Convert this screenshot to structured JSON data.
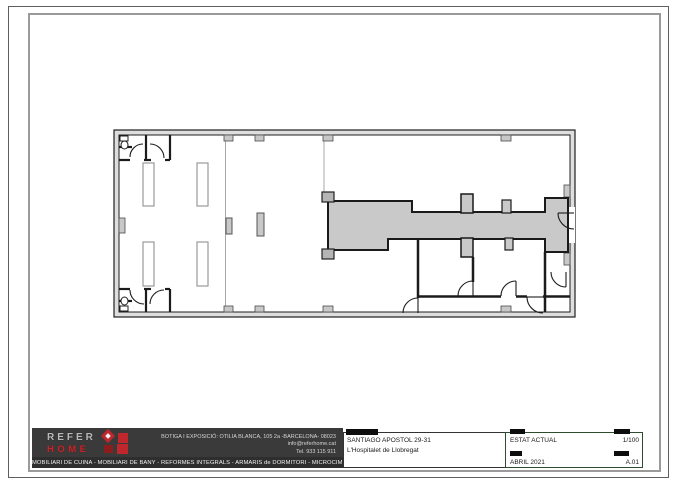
{
  "sheet": {
    "border_color": "#5f5f5f",
    "frame_color": "#9a9a9a"
  },
  "plan": {
    "kind": "architectural floor plan, current state",
    "wall_color": "#1b1b1b",
    "wall_fill": "#dedede",
    "corridor_fill": "#c9c9c9",
    "column_fill": "#c8c8c8"
  },
  "brand": {
    "name_top": "REFER",
    "name_bottom": "HOME",
    "accent": "#c0272d",
    "gray": "#b9b9b9"
  },
  "contact": {
    "address": "BOTIGA I EXPOSICIÓ: OTILIA BLANCA, 105 2a -BARCELONA- 08023",
    "email": "info@referhome.cat",
    "phone": "Tel. 933 115 911"
  },
  "services": "MOBILIARI DE CUINA - MOBILIARI DE BANY - REFORMES INTEGRALS - ARMARIS de DORMITORI - MICROCIMENT",
  "project": {
    "street": "SANTIAGO APOSTOL 29-31",
    "city": "L'Hospitalet de Llobregat"
  },
  "fields": {
    "status": "ESTAT ACTUAL",
    "scale": "1/100",
    "date": "ABRIL 2021",
    "sheet_number": "A.01"
  }
}
